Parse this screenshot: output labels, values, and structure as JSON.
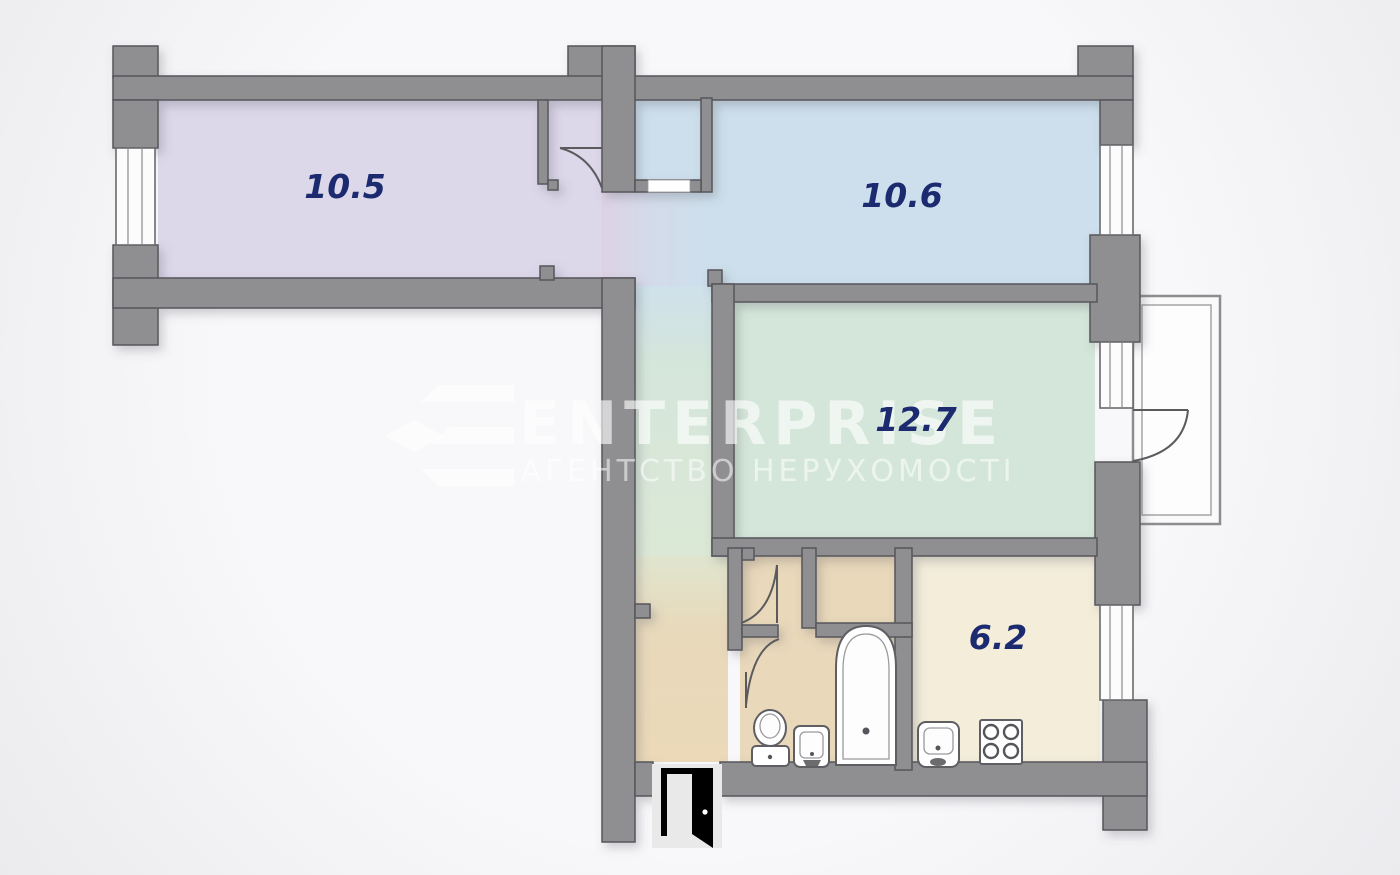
{
  "watermark": {
    "brand": "ENTERPRISE",
    "subtitle": "АГЕНТСТВО НЕРУХОМОСТІ"
  },
  "rooms": {
    "room1": {
      "label": "10.5"
    },
    "room2": {
      "label": "10.6"
    },
    "room3": {
      "label": "12.7"
    },
    "kitchen": {
      "label": "6.2"
    }
  },
  "colors": {
    "wall": "#8f8f91",
    "wall_outline": "#57575b",
    "room1_floor": "#dcd7e9",
    "room2_floor": "#cddfec",
    "room3_floor": "#d4e6d9",
    "kitchen_floor": "#f3edda",
    "hall_floor": "#e9d8ba",
    "label_text": "#1c2a70",
    "background": "#f5f5f6"
  }
}
